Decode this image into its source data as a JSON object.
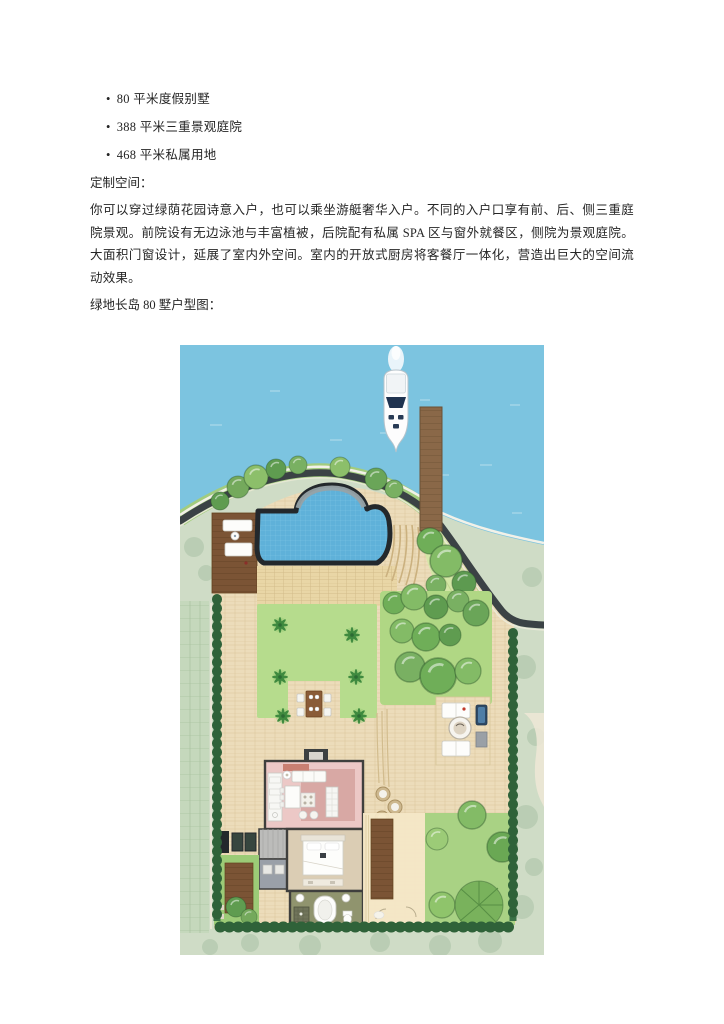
{
  "document": {
    "bullet_marker": "•",
    "bullets": [
      "80 平米度假别墅",
      "388 平米三重景观庭院",
      "468 平米私属用地"
    ],
    "section_label": "定制空间：",
    "paragraph": "你可以穿过绿荫花园诗意入户，也可以乘坐游艇奢华入户。不同的入户口享有前、后、侧三重庭院景观。前院设有无边泳池与丰富植被，后院配有私属 SPA 区与窗外就餐区，侧院为景观庭院。大面积门窗设计，延展了室内外空间。室内的开放式厨房将客餐厅一体化，营造出巨大的空间流动效果。",
    "caption": "绿地长岛 80 墅户型图："
  },
  "site_plan": {
    "colors": {
      "water": "#7cc4e0",
      "pool": "#5fb1d9",
      "paving": "#ecdcba",
      "lawn": "#b6dc8d",
      "contour_lawn": "#d4e6a6",
      "outside": "#cfdcc6",
      "wood_deck": "#7b5435",
      "dock_wood": "#8a6848",
      "living_room": "#ecc8c6",
      "bedroom": "#dbcdb4",
      "bathroom": "#90946e",
      "hedge": "#2f6239",
      "shoreline": "#3b4245",
      "boat_hull": "#fdfdfd",
      "boat_glass": "#1f3350"
    }
  }
}
